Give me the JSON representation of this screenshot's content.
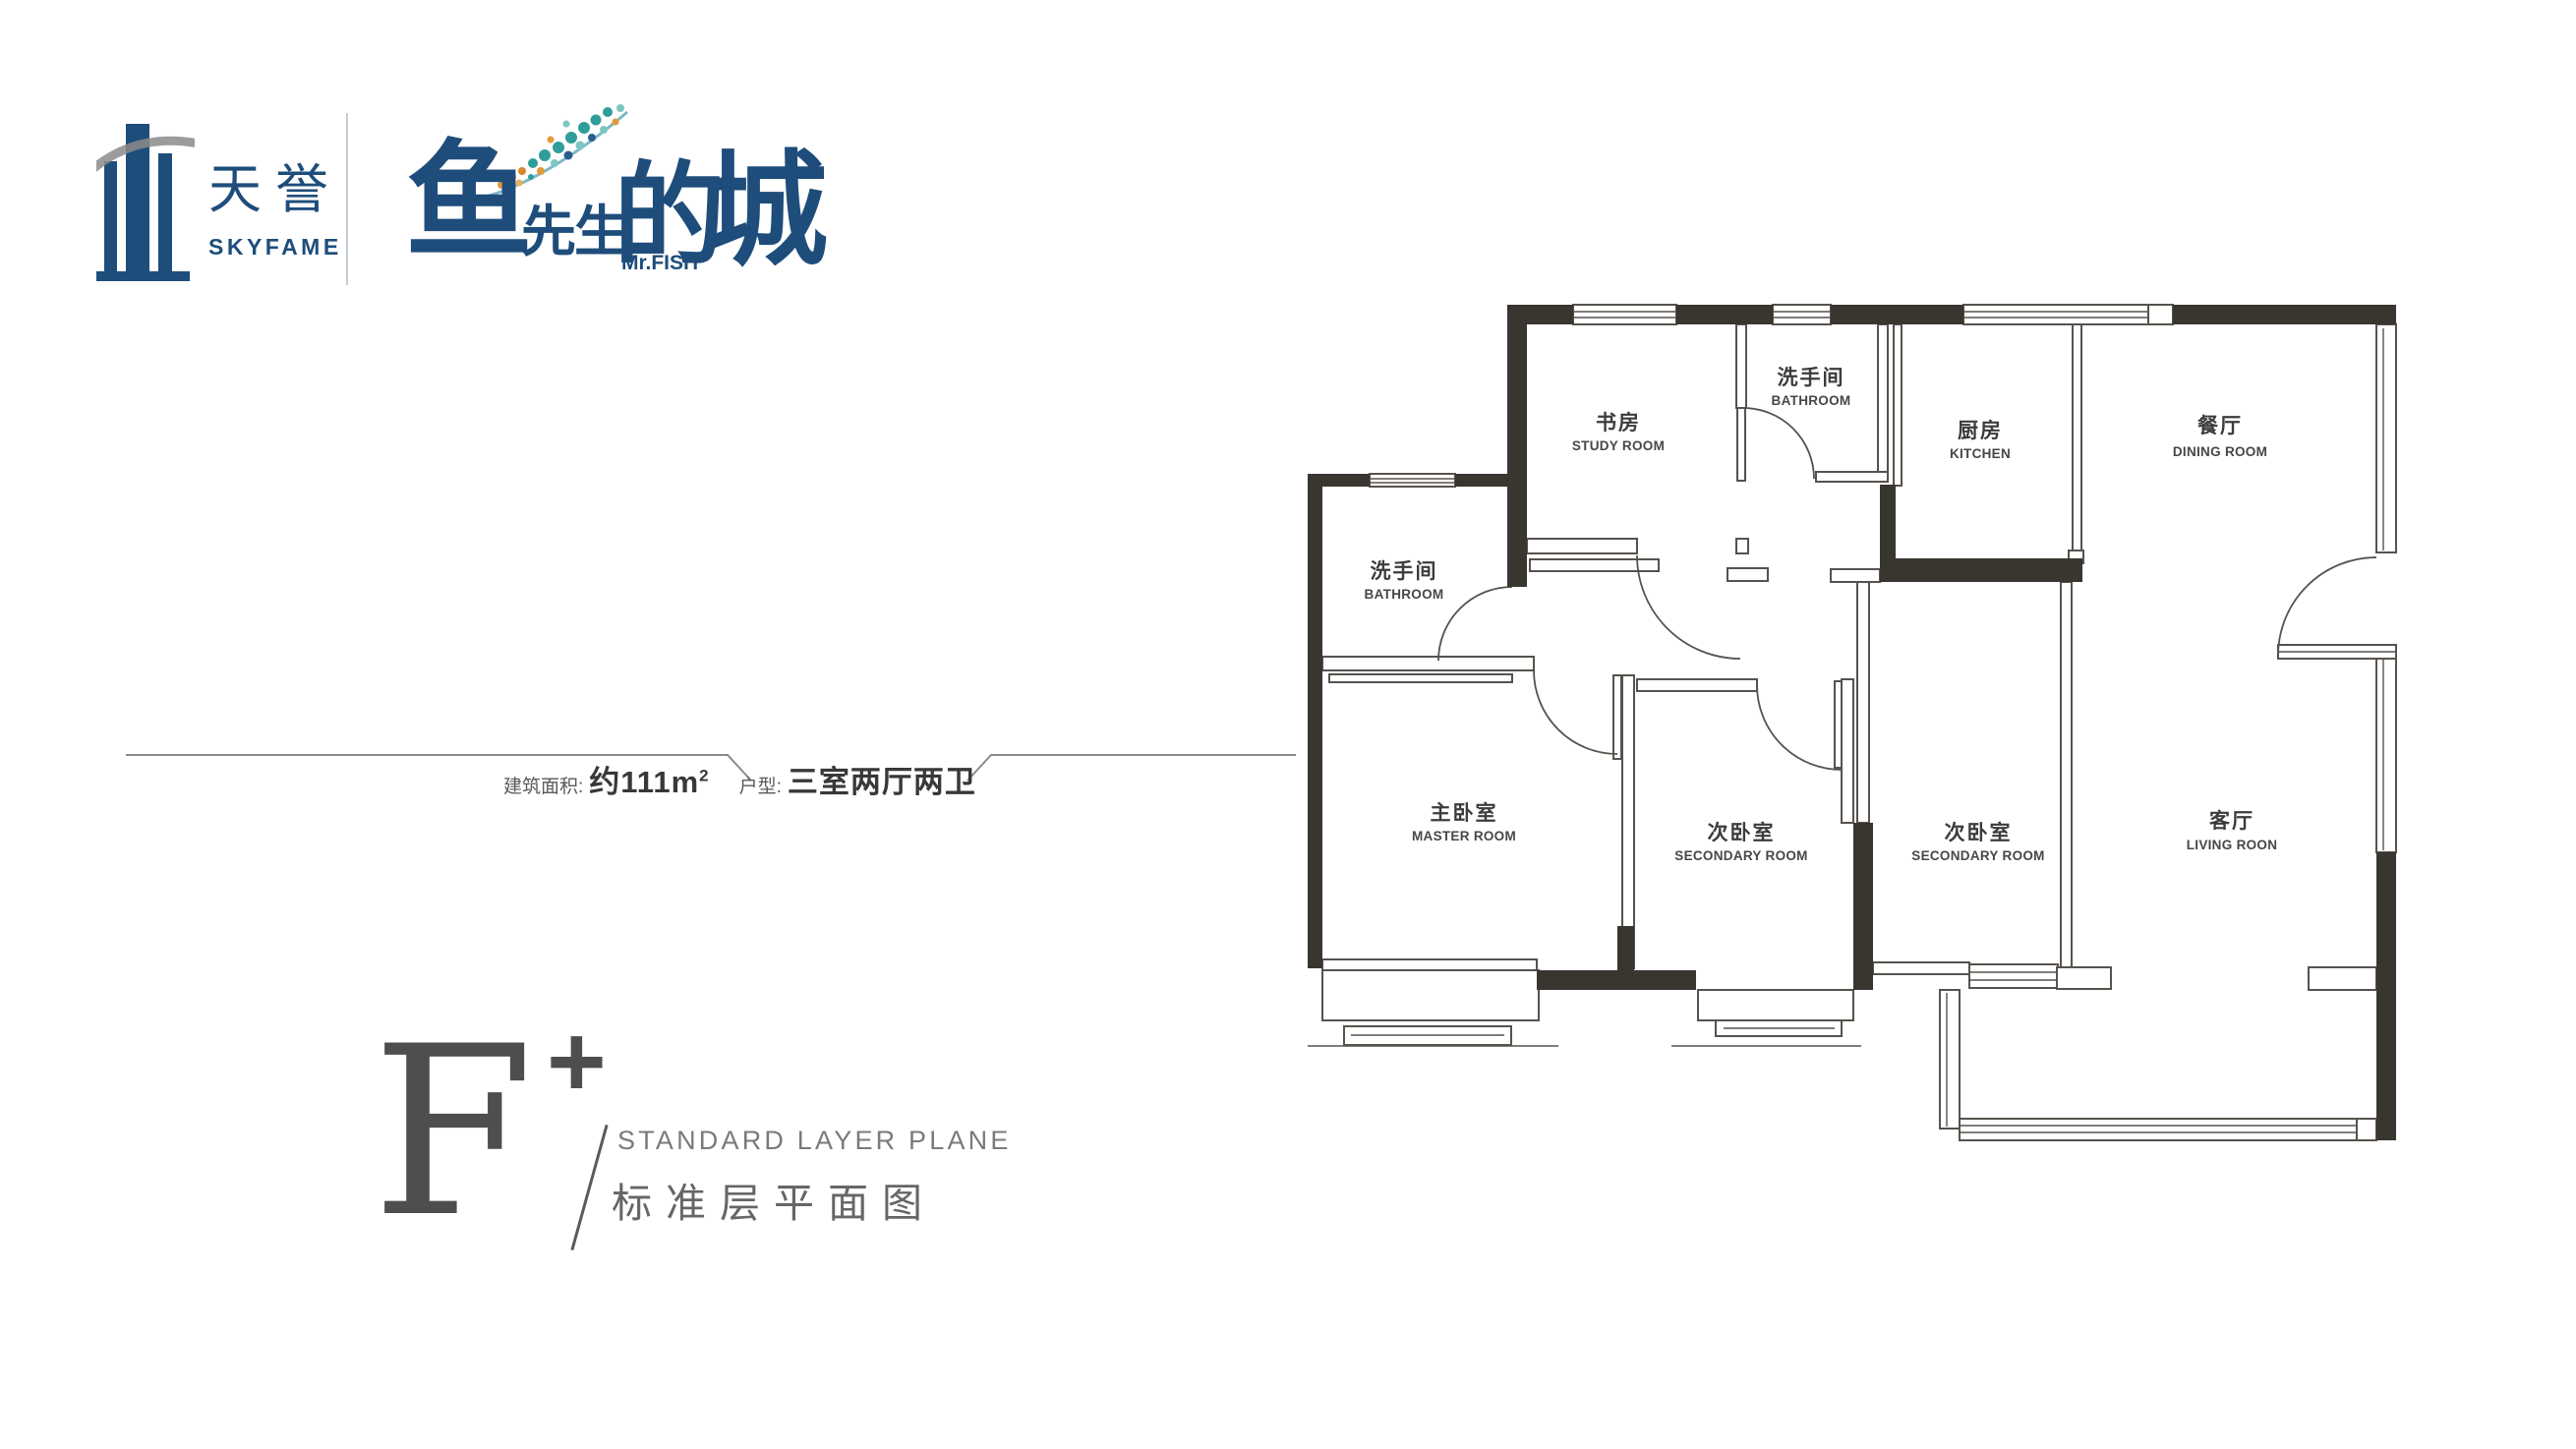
{
  "brand": {
    "logo_cn": "天誉",
    "logo_en": "SKYFAME",
    "product_char_1": "鱼",
    "product_char_23": "先生",
    "product_char_4": "的",
    "product_char_5": "城",
    "product_en": "Mr.FISH",
    "navy": "#1e4d7b",
    "teal": "#2f9e9a",
    "orange": "#e39a3b"
  },
  "title": {
    "letter": "F",
    "plus": "+",
    "subtitle_en": "STANDARD LAYER PLANE",
    "subtitle_cn": "标准层平面图"
  },
  "specs": {
    "area_label": "建筑面积:",
    "area_value": "约111m",
    "area_sup": "2",
    "type_label": "户型:",
    "type_value": "三室两厅两卫"
  },
  "floorplan": {
    "wall_color": "#39352f",
    "line_color": "#57524d",
    "rooms": [
      {
        "cn": "书房",
        "en": "STUDY ROOM"
      },
      {
        "cn": "洗手间",
        "en": "BATHROOM"
      },
      {
        "cn": "厨房",
        "en": "KITCHEN"
      },
      {
        "cn": "餐厅",
        "en": "DINING ROOM"
      },
      {
        "cn": "洗手间",
        "en": "BATHROOM"
      },
      {
        "cn": "主卧室",
        "en": "MASTER ROOM"
      },
      {
        "cn": "次卧室",
        "en": "SECONDARY ROOM"
      },
      {
        "cn": "次卧室",
        "en": "SECONDARY ROOM"
      },
      {
        "cn": "客厅",
        "en": "LIVING ROON"
      }
    ]
  }
}
